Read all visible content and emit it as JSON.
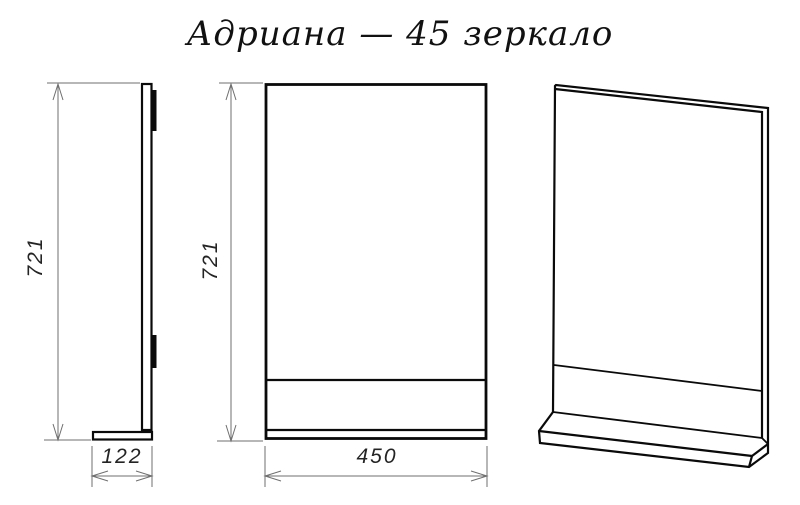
{
  "title": "Адриана — 45 зеркало",
  "dimensions": {
    "side_height": "721",
    "front_height": "721",
    "depth": "122",
    "width": "450"
  },
  "colors": {
    "line": "#0a0a0a",
    "dimension": "#6f6f6f",
    "text": "#242424",
    "background": "#ffffff"
  }
}
